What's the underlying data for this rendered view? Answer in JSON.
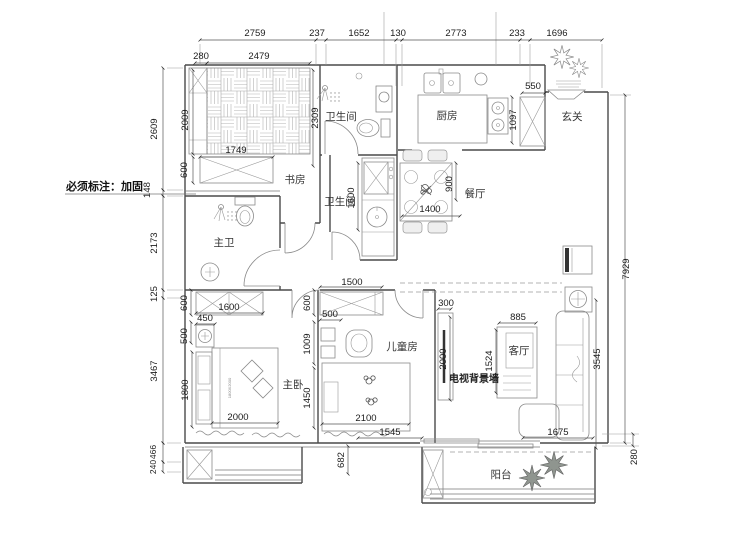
{
  "note": "必须标注：加固",
  "rooms": {
    "study": "书房",
    "bath_top": "卫生间",
    "kitchen": "厨房",
    "entry": "玄关",
    "master_bath": "主卫",
    "bath_mid": "卫生间",
    "dining": "餐厅",
    "master_bedroom": "主卧",
    "kids_room": "儿童房",
    "living_room": "客厅",
    "tv_wall": "电视背景墙",
    "balcony": "阳台"
  },
  "dims": {
    "top": [
      "2759",
      "237",
      "1652",
      "130",
      "2773",
      "233",
      "1696"
    ],
    "top2": [
      "280",
      "2479",
      "550"
    ],
    "left": [
      "2609",
      "148",
      "2173",
      "125",
      "3467",
      "466",
      "240"
    ],
    "right": [
      "7929",
      "280"
    ],
    "study": [
      "2009",
      "600",
      "1749",
      "2309"
    ],
    "kitchen": [
      "1097"
    ],
    "bath_mid": [
      "1600"
    ],
    "dining": [
      "1400",
      "900"
    ],
    "master": [
      "600",
      "1600",
      "450",
      "500",
      "1800",
      "2000"
    ],
    "kids": [
      "1500",
      "600",
      "500",
      "1009",
      "1450",
      "2100",
      "1545",
      "682"
    ],
    "living": [
      "300",
      "2000",
      "885",
      "1524",
      "3545",
      "1675"
    ],
    "bed_size": "1800X2000"
  }
}
